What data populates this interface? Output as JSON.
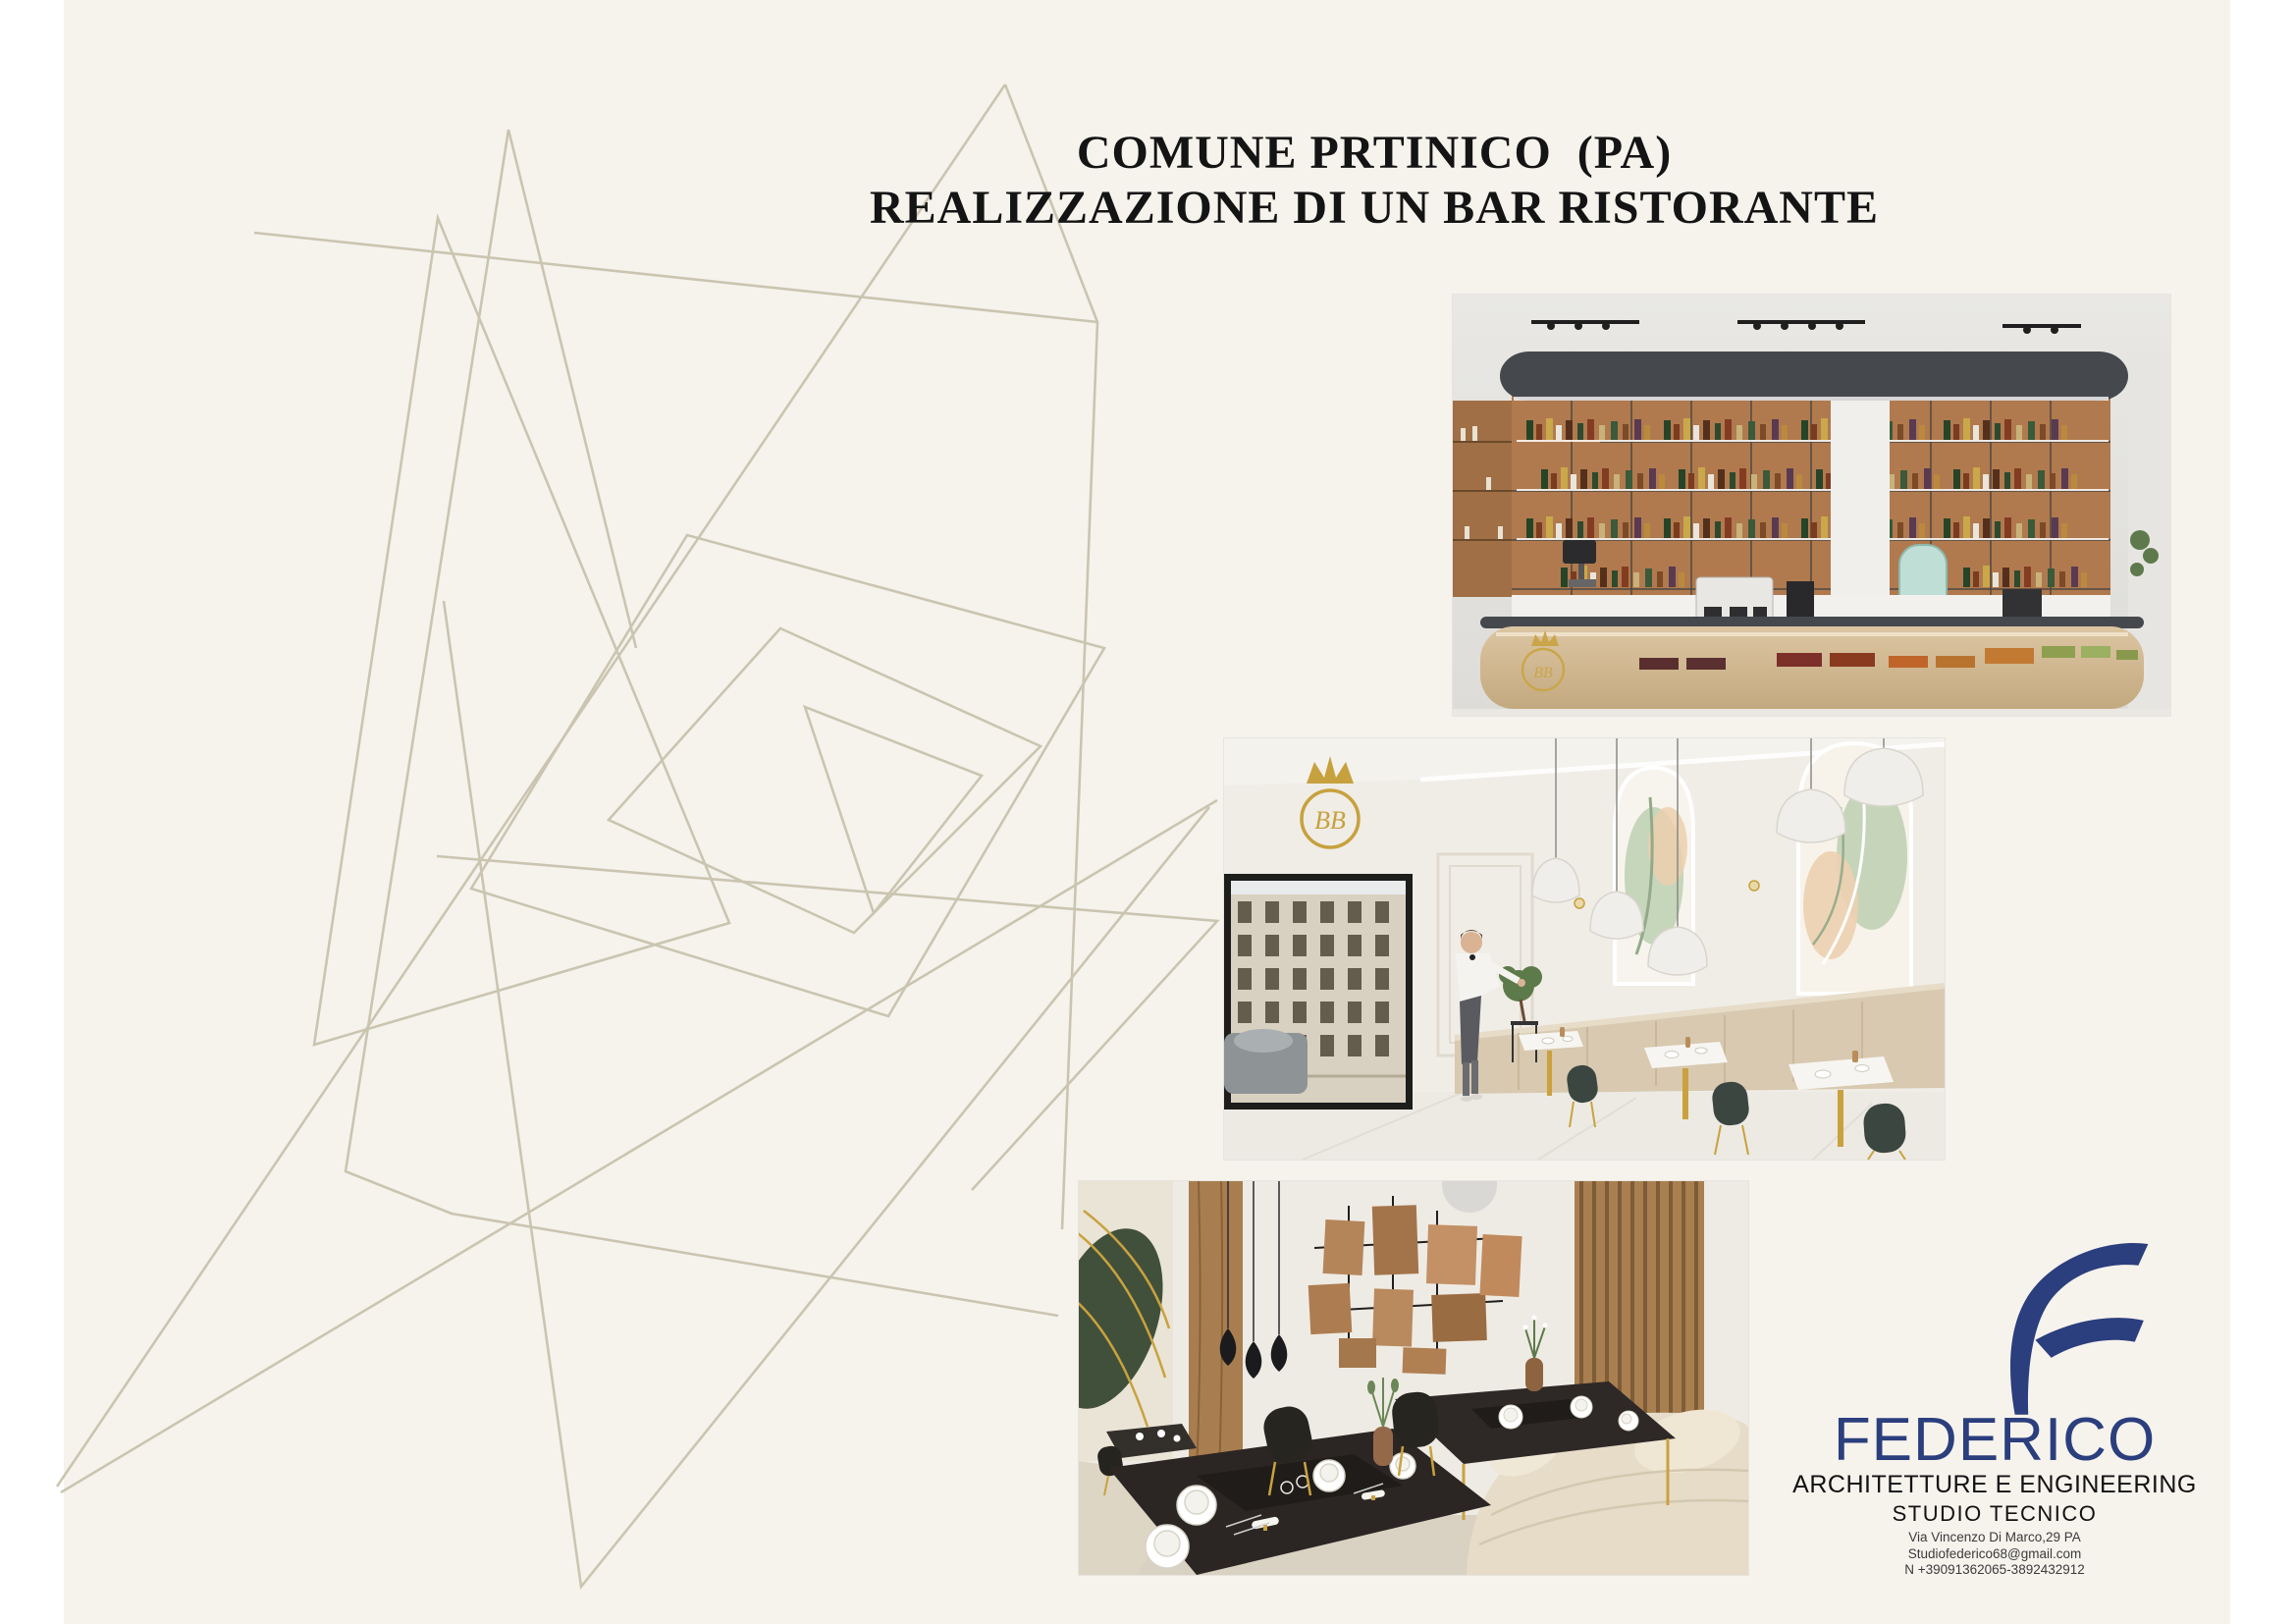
{
  "document": {
    "title_line1": "COMUNE PRTINICO  (PA)",
    "title_line2": "REALIZZAZIONE DI UN BAR RISTORANTE"
  },
  "renders": {
    "monogram": "BB"
  },
  "brand": {
    "wordmark": "FEDERICO",
    "tagline": "ARCHITETTURE E ENGINEERING",
    "studio": "STUDIO TECNICO",
    "address": "Via Vincenzo Di Marco,29 PA",
    "email": "Studiofederico68@gmail.com",
    "phone": "N +39091362065-3892432912"
  },
  "colors": {
    "page_bg": "#ffffff",
    "canvas_bg": "#f6f3ed",
    "line_art": "#c8c3ad",
    "title_text": "#141414",
    "brand_blue": "#2b3e7d",
    "gold": "#c9a23f",
    "counter_dark": "#45484c",
    "shelf_wood": "#b07a4e"
  }
}
